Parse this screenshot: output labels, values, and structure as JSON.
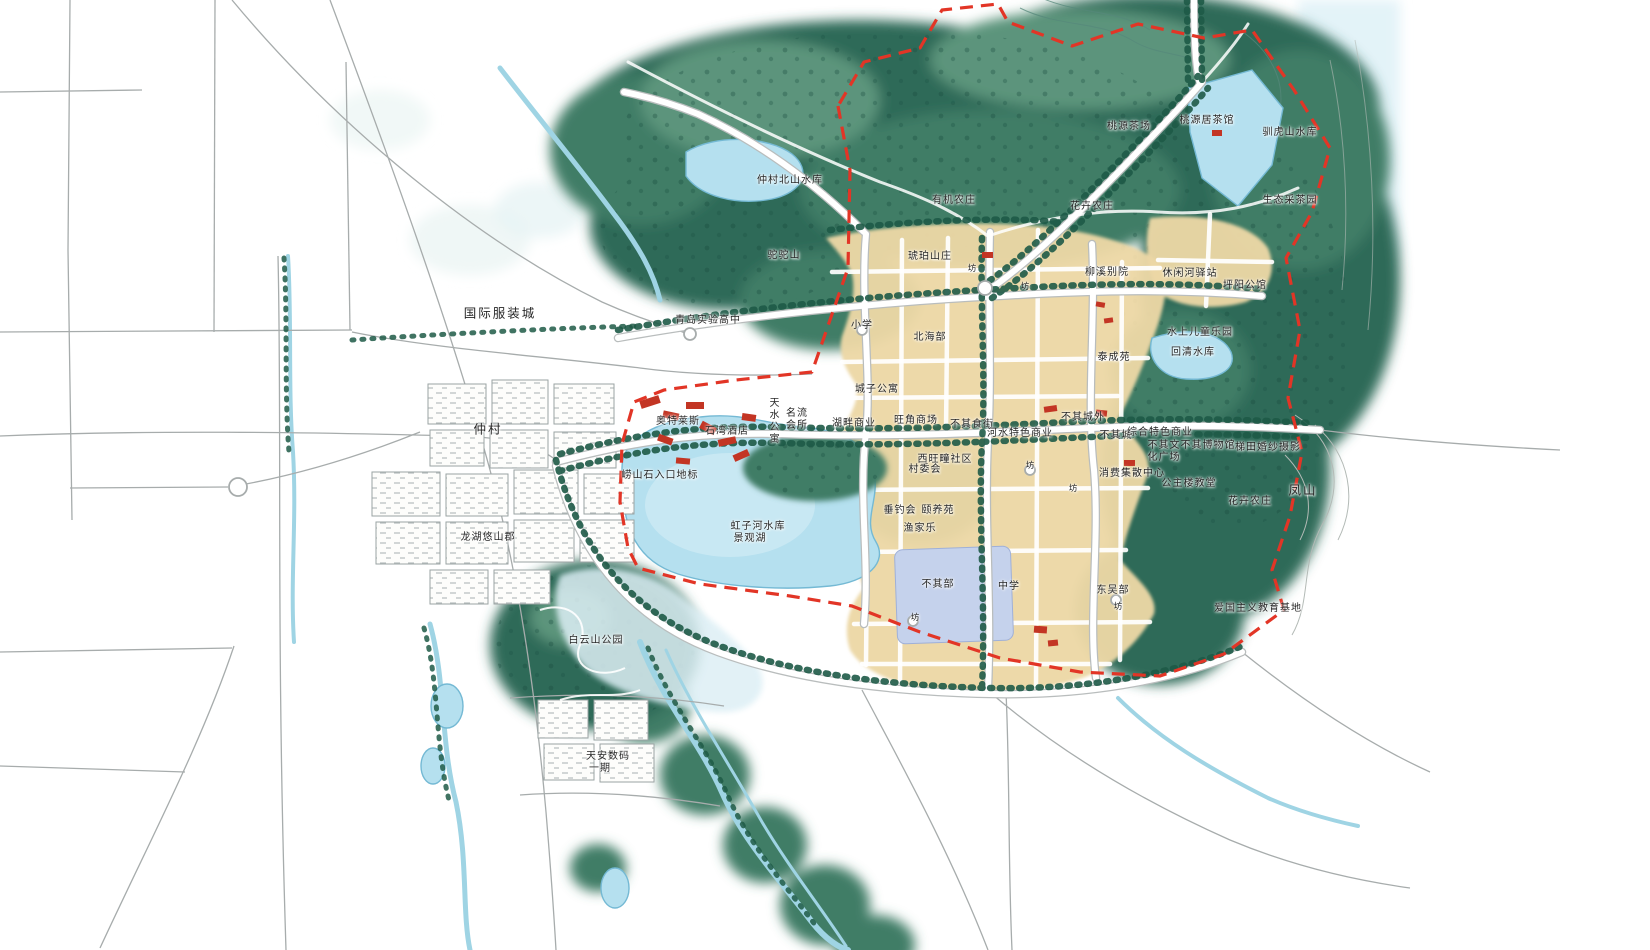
{
  "map": {
    "palette": {
      "forest_dark": "#2f6b58",
      "forest_mid": "#3f7d66",
      "forest_light": "#5b947b",
      "tree_green": "#1e5a47",
      "water_blue": "#b5e0ef",
      "water_deep": "#74b9d4",
      "water_pale": "#ddeff5",
      "stream_blue": "#9fd4e4",
      "pale_cyan": "#e3f3f8",
      "parcel_tan": "#ecd7a5",
      "road_casing": "#b9bdbd",
      "road_thin": "#a7acac",
      "boundary_red": "#e23526",
      "building_red": "#c33524",
      "school_blue": "#c5d2ec",
      "label_ink": "#262626"
    },
    "labels": [
      {
        "text": "桃源茶场",
        "x": 1129,
        "y": 127
      },
      {
        "text": "桃源居茶馆",
        "x": 1207,
        "y": 121
      },
      {
        "text": "驯虎山水库",
        "x": 1290,
        "y": 133
      },
      {
        "text": "生态采茶园",
        "x": 1290,
        "y": 201
      },
      {
        "text": "仲村北山水库",
        "x": 790,
        "y": 181
      },
      {
        "text": "有机农庄",
        "x": 954,
        "y": 201
      },
      {
        "text": "花卉农庄",
        "x": 1092,
        "y": 207
      },
      {
        "text": "驼驼山",
        "x": 784,
        "y": 256
      },
      {
        "text": "琥珀山庄",
        "x": 930,
        "y": 257
      },
      {
        "text": "柳溪别院",
        "x": 1107,
        "y": 273
      },
      {
        "text": "休闲河驿站",
        "x": 1190,
        "y": 274
      },
      {
        "text": "坪阳公馆",
        "x": 1245,
        "y": 286
      },
      {
        "text": "国际服装城",
        "x": 500,
        "y": 313,
        "mode": "big"
      },
      {
        "text": "青岛实验高中",
        "x": 708,
        "y": 321
      },
      {
        "text": "小学",
        "x": 862,
        "y": 326
      },
      {
        "text": "北海部",
        "x": 930,
        "y": 338
      },
      {
        "text": "水上儿童乐园",
        "x": 1200,
        "y": 333
      },
      {
        "text": "回清水库",
        "x": 1193,
        "y": 353
      },
      {
        "text": "泰成苑",
        "x": 1114,
        "y": 358
      },
      {
        "text": "城子公寓",
        "x": 877,
        "y": 390
      },
      {
        "text": "奥特莱斯",
        "x": 678,
        "y": 422
      },
      {
        "text": "石湾酒店",
        "x": 727,
        "y": 432
      },
      {
        "text": "天水公寓",
        "x": 772,
        "y": 421,
        "mode": "v"
      },
      {
        "text": "名流\n会所",
        "x": 797,
        "y": 420
      },
      {
        "text": "湖畔商业",
        "x": 854,
        "y": 424
      },
      {
        "text": "旺角商场",
        "x": 916,
        "y": 421
      },
      {
        "text": "不其食街",
        "x": 972,
        "y": 425
      },
      {
        "text": "河水特色商业",
        "x": 1020,
        "y": 434
      },
      {
        "text": "不其城外",
        "x": 1083,
        "y": 418
      },
      {
        "text": "不其城",
        "x": 1116,
        "y": 436
      },
      {
        "text": "综合特色商业",
        "x": 1160,
        "y": 433
      },
      {
        "text": "不其文\n化广场",
        "x": 1164,
        "y": 452
      },
      {
        "text": "不其博物馆",
        "x": 1208,
        "y": 446
      },
      {
        "text": "梯田婚纱摄影",
        "x": 1268,
        "y": 448
      },
      {
        "text": "消费集散中心",
        "x": 1132,
        "y": 474
      },
      {
        "text": "公主楼教堂",
        "x": 1189,
        "y": 484
      },
      {
        "text": "花卉农庄",
        "x": 1250,
        "y": 502
      },
      {
        "text": "凤山",
        "x": 1303,
        "y": 490,
        "mode": "big"
      },
      {
        "text": "仲村",
        "x": 488,
        "y": 429,
        "mode": "big"
      },
      {
        "text": "崂山石入口地标",
        "x": 660,
        "y": 476
      },
      {
        "text": "西旺疃社区",
        "x": 945,
        "y": 460
      },
      {
        "text": "村委会",
        "x": 925,
        "y": 470
      },
      {
        "text": "垂钓会",
        "x": 900,
        "y": 511
      },
      {
        "text": "颐养苑",
        "x": 938,
        "y": 511
      },
      {
        "text": "渔家乐",
        "x": 920,
        "y": 529
      },
      {
        "text": "虹子河水库",
        "x": 758,
        "y": 527
      },
      {
        "text": "景观湖",
        "x": 750,
        "y": 539
      },
      {
        "text": "龙湖悠山郡",
        "x": 488,
        "y": 538
      },
      {
        "text": "不其部",
        "x": 938,
        "y": 585
      },
      {
        "text": "中学",
        "x": 1009,
        "y": 587
      },
      {
        "text": "东吴部",
        "x": 1113,
        "y": 591
      },
      {
        "text": "白云山公园",
        "x": 596,
        "y": 641
      },
      {
        "text": "天安数码",
        "x": 608,
        "y": 757
      },
      {
        "text": "一期",
        "x": 600,
        "y": 769
      },
      {
        "text": "爱国主义教育基地",
        "x": 1258,
        "y": 609
      },
      {
        "text": "坊",
        "x": 972,
        "y": 269,
        "mode": "small"
      },
      {
        "text": "坊",
        "x": 1025,
        "y": 287,
        "mode": "small"
      },
      {
        "text": "坊",
        "x": 1030,
        "y": 466,
        "mode": "small"
      },
      {
        "text": "坊",
        "x": 1073,
        "y": 489,
        "mode": "small"
      },
      {
        "text": "坊",
        "x": 915,
        "y": 618,
        "mode": "small"
      },
      {
        "text": "坊",
        "x": 1118,
        "y": 607,
        "mode": "small"
      }
    ]
  }
}
